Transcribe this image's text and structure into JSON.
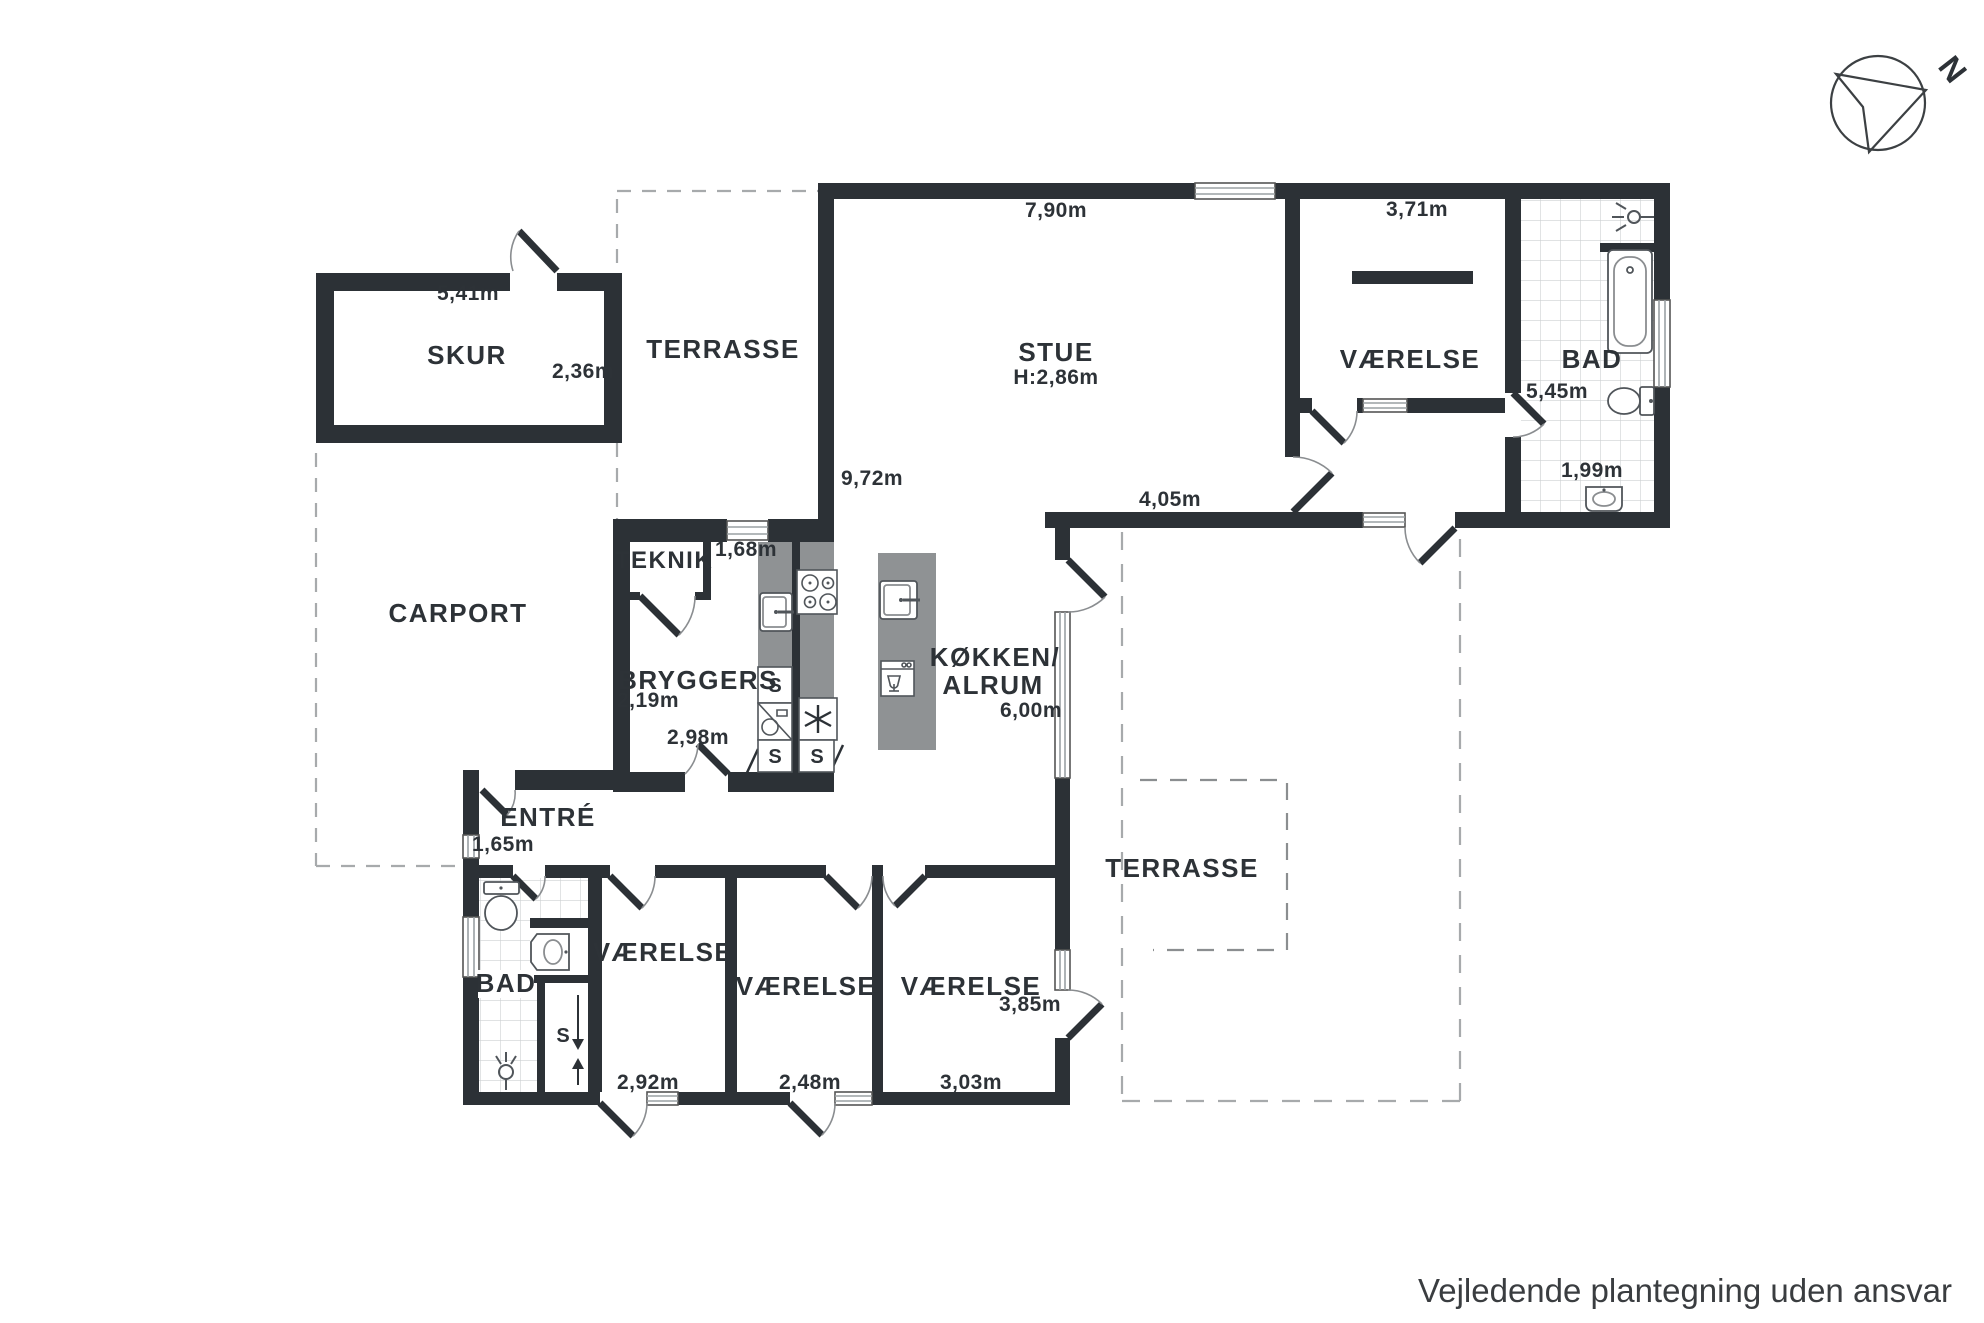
{
  "footer": {
    "note": "Vejledende plantegning uden ansvar"
  },
  "compass": {
    "label": "N"
  },
  "cabinet_letter": "S",
  "colors": {
    "wall": "#2c3136",
    "counter": "#8f9294",
    "window_line": "#9aa0a3",
    "tile_line": "#cdd0d2",
    "dash": "#a7aaac",
    "text": "#2d3237"
  },
  "rooms": {
    "skur": {
      "label": "SKUR",
      "width": "5,41m",
      "depth": "2,36m"
    },
    "terrasse_top": {
      "label": "TERRASSE"
    },
    "stue": {
      "label": "STUE",
      "ceiling": "H:2,86m",
      "width": "7,90m",
      "depth": "9,72m",
      "south_wall": "4,05m"
    },
    "vaerelse_ne": {
      "label": "VÆRELSE",
      "width": "3,71m"
    },
    "bad_ne": {
      "label": "BAD",
      "depth": "5,45m",
      "width": "1,99m"
    },
    "carport": {
      "label": "CARPORT"
    },
    "teknik": {
      "label": "TEKNIK",
      "width": "1,68m"
    },
    "bryggers": {
      "label": "BRYGGERS",
      "width": "2,19m",
      "depth": "2,98m"
    },
    "koekken": {
      "label_line1": "KØKKEN/",
      "label_line2": "ALRUM",
      "width": "6,00m"
    },
    "entre": {
      "label": "ENTRÉ",
      "width": "1,65m"
    },
    "terrasse_east": {
      "label": "TERRASSE"
    },
    "bad_sw": {
      "label": "BAD"
    },
    "vaerelse_1": {
      "label": "VÆRELSE",
      "width": "2,92m"
    },
    "vaerelse_2": {
      "label": "VÆRELSE",
      "width": "2,48m"
    },
    "vaerelse_3": {
      "label": "VÆRELSE",
      "width": "3,03m",
      "depth": "3,85m"
    }
  }
}
